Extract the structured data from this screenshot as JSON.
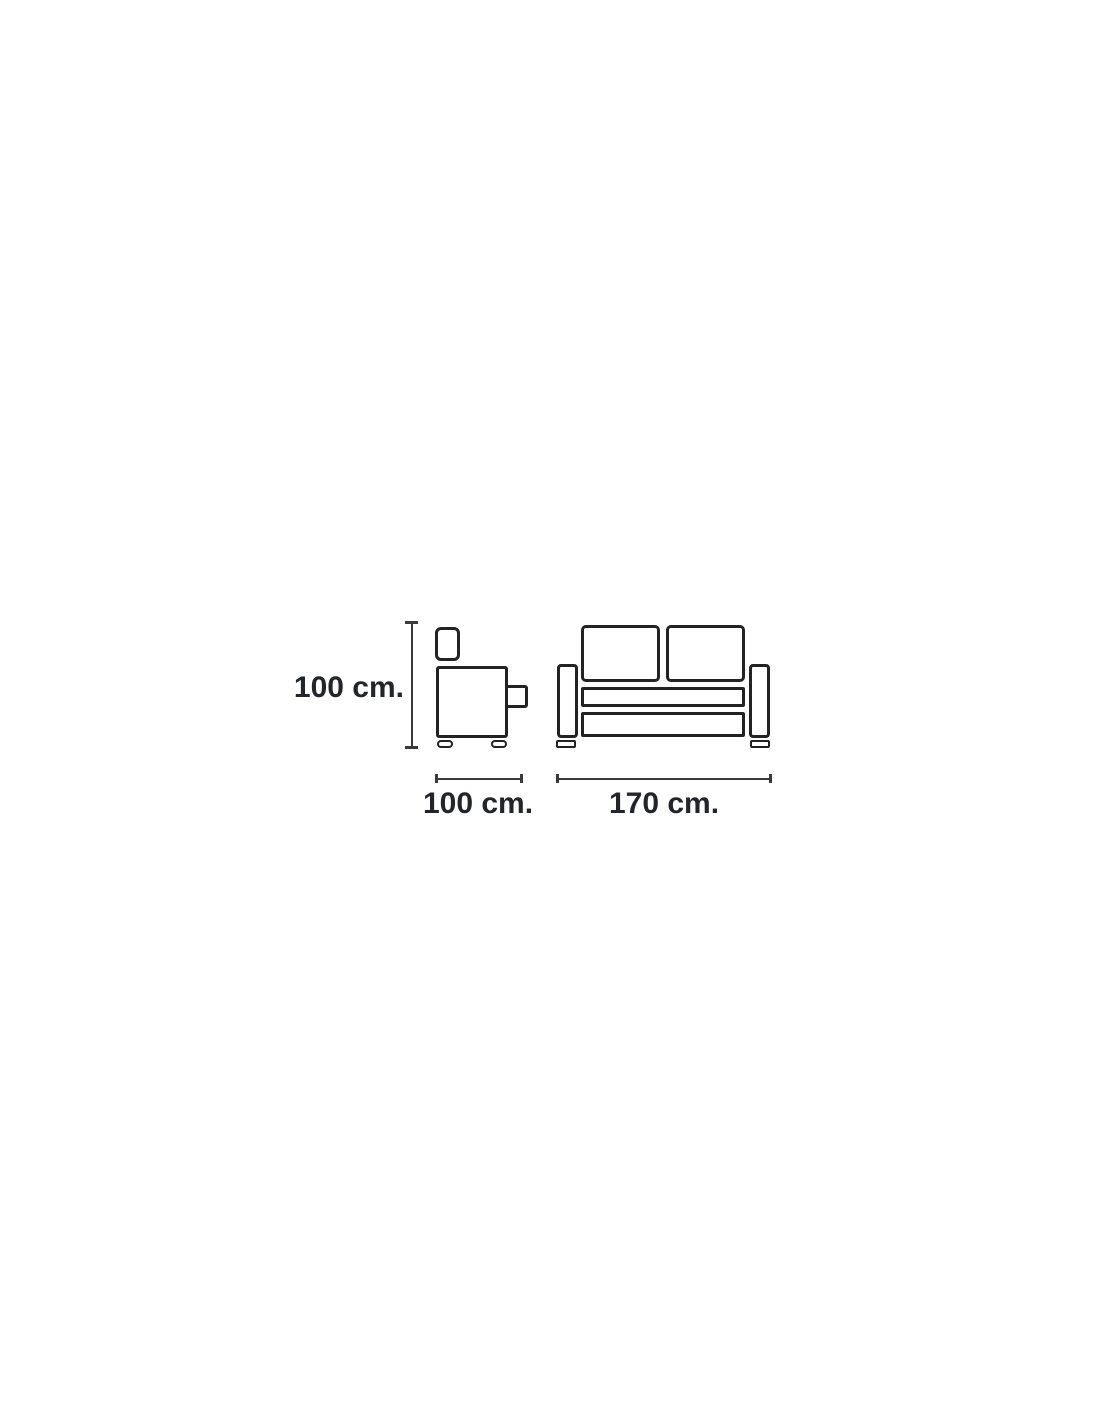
{
  "diagram": {
    "description": "Sofa dimension line drawing with side view and front view",
    "labels": {
      "height": "100 cm.",
      "depth": "100 cm.",
      "width": "170 cm."
    },
    "colors": {
      "c-outline": "#232323",
      "c-dim": "#3a3a3a",
      "c-text": "#22252b",
      "c-bg": "#ffffff"
    }
  }
}
